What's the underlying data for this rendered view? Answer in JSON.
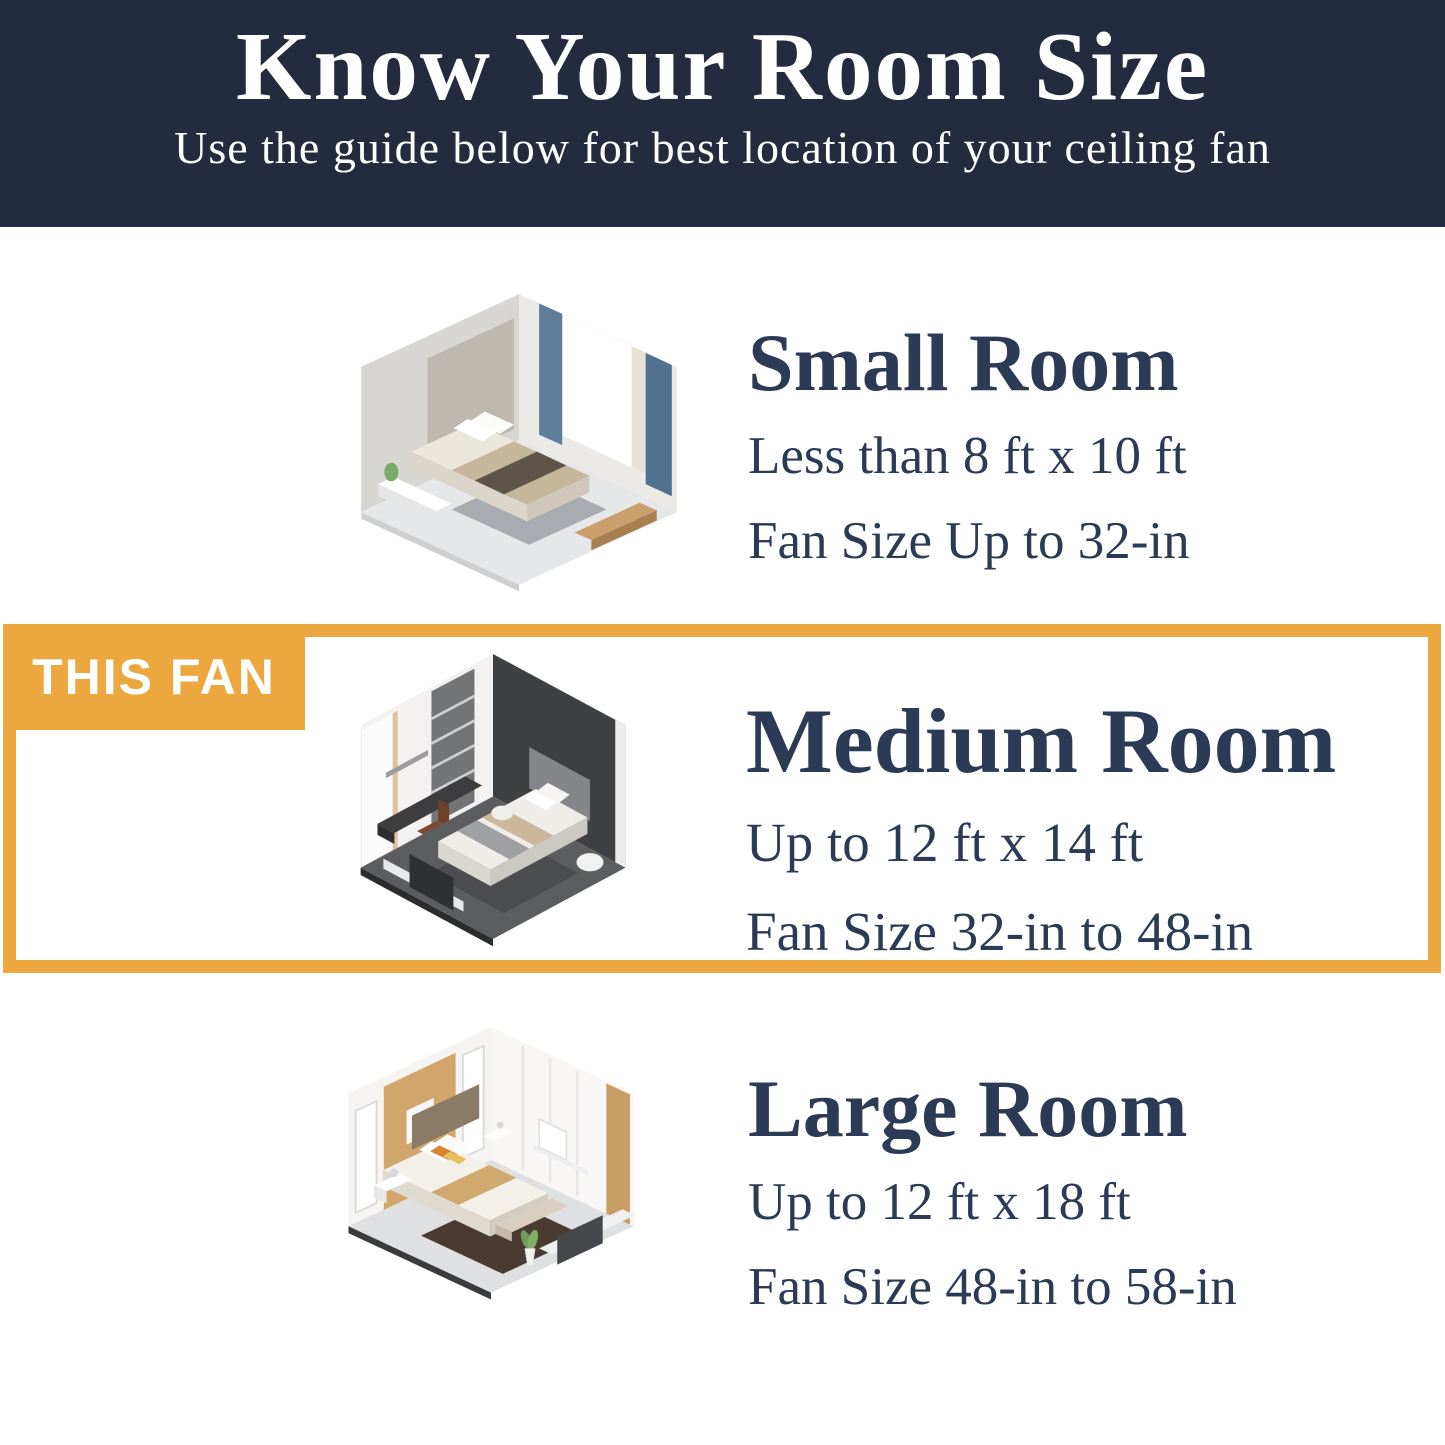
{
  "header": {
    "title": "Know Your Room Size",
    "subtitle": "Use the guide below for best location of your ceiling fan"
  },
  "highlight_label": "THIS FAN",
  "sections": [
    {
      "id": "small",
      "title": "Small Room",
      "dimensions": "Less than 8 ft x 10 ft",
      "fan_size": "Fan Size Up to 32-in",
      "highlighted": false
    },
    {
      "id": "medium",
      "title": "Medium Room",
      "dimensions": "Up to 12 ft x 14 ft",
      "fan_size": "Fan Size 32-in to 48-in",
      "highlighted": true
    },
    {
      "id": "large",
      "title": "Large Room",
      "dimensions": "Up to 12 ft x 18 ft",
      "fan_size": "Fan Size 48-in to 58-in",
      "highlighted": false
    }
  ],
  "colors": {
    "header_bg": "#252b3f",
    "text_navy": "#2b3a55",
    "accent_orange": "#eca73f",
    "badge_text": "#ffffff"
  }
}
